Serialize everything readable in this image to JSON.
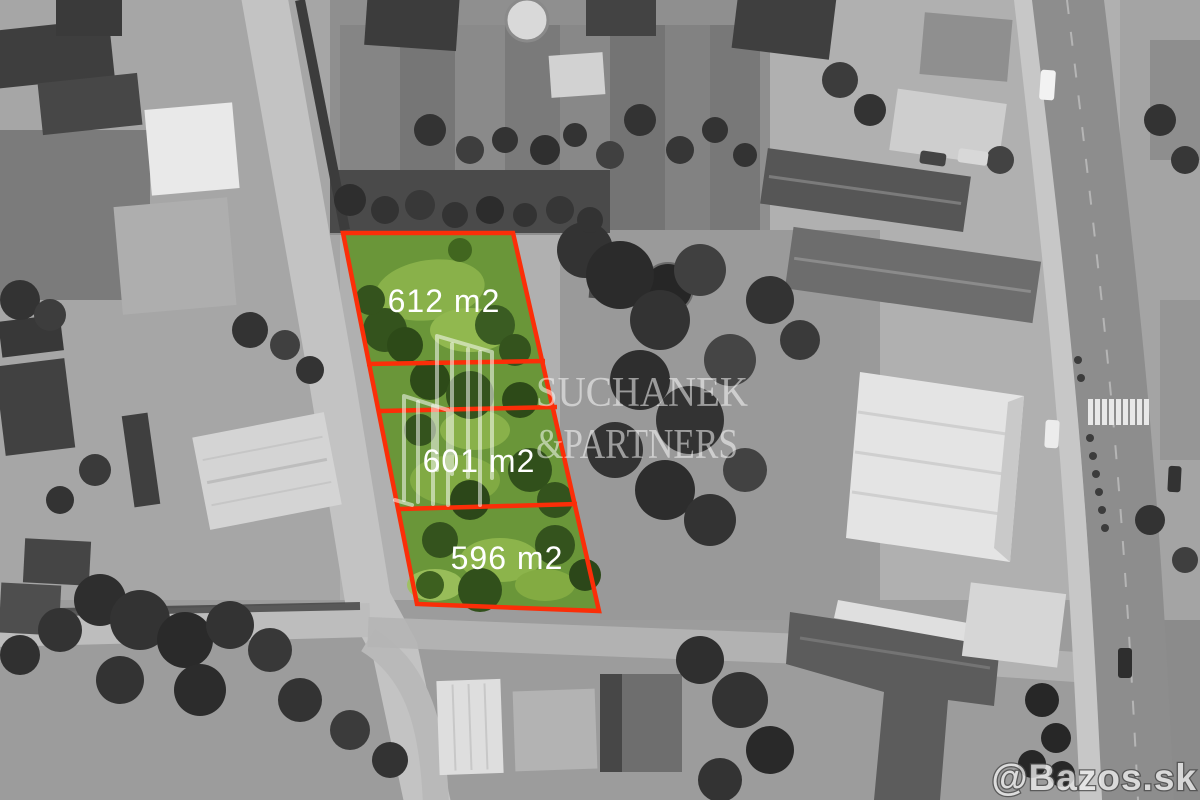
{
  "image": {
    "kind": "grayscale aerial drone photo of a village street block",
    "highlight": "three adjacent building plots tinted green and outlined in red"
  },
  "plots": [
    {
      "id": 1,
      "area_label": "612 m2"
    },
    {
      "id": 2,
      "area_label": "601 m2"
    },
    {
      "id": 3,
      "area_label": "596 m2"
    }
  ],
  "watermark": {
    "logo": "line-drawn-buildings-icon",
    "brand_line1": "SUCHANEK",
    "brand_line2": "&PARTNERS"
  },
  "footer_watermark": {
    "site": "@Bazos.sk"
  },
  "theme": {
    "outline-red": "#fb2e08",
    "plot-green": "#6a9639",
    "label-text": "#ffffff",
    "watermark-text": "rgba(255,255,255,0.52)"
  }
}
